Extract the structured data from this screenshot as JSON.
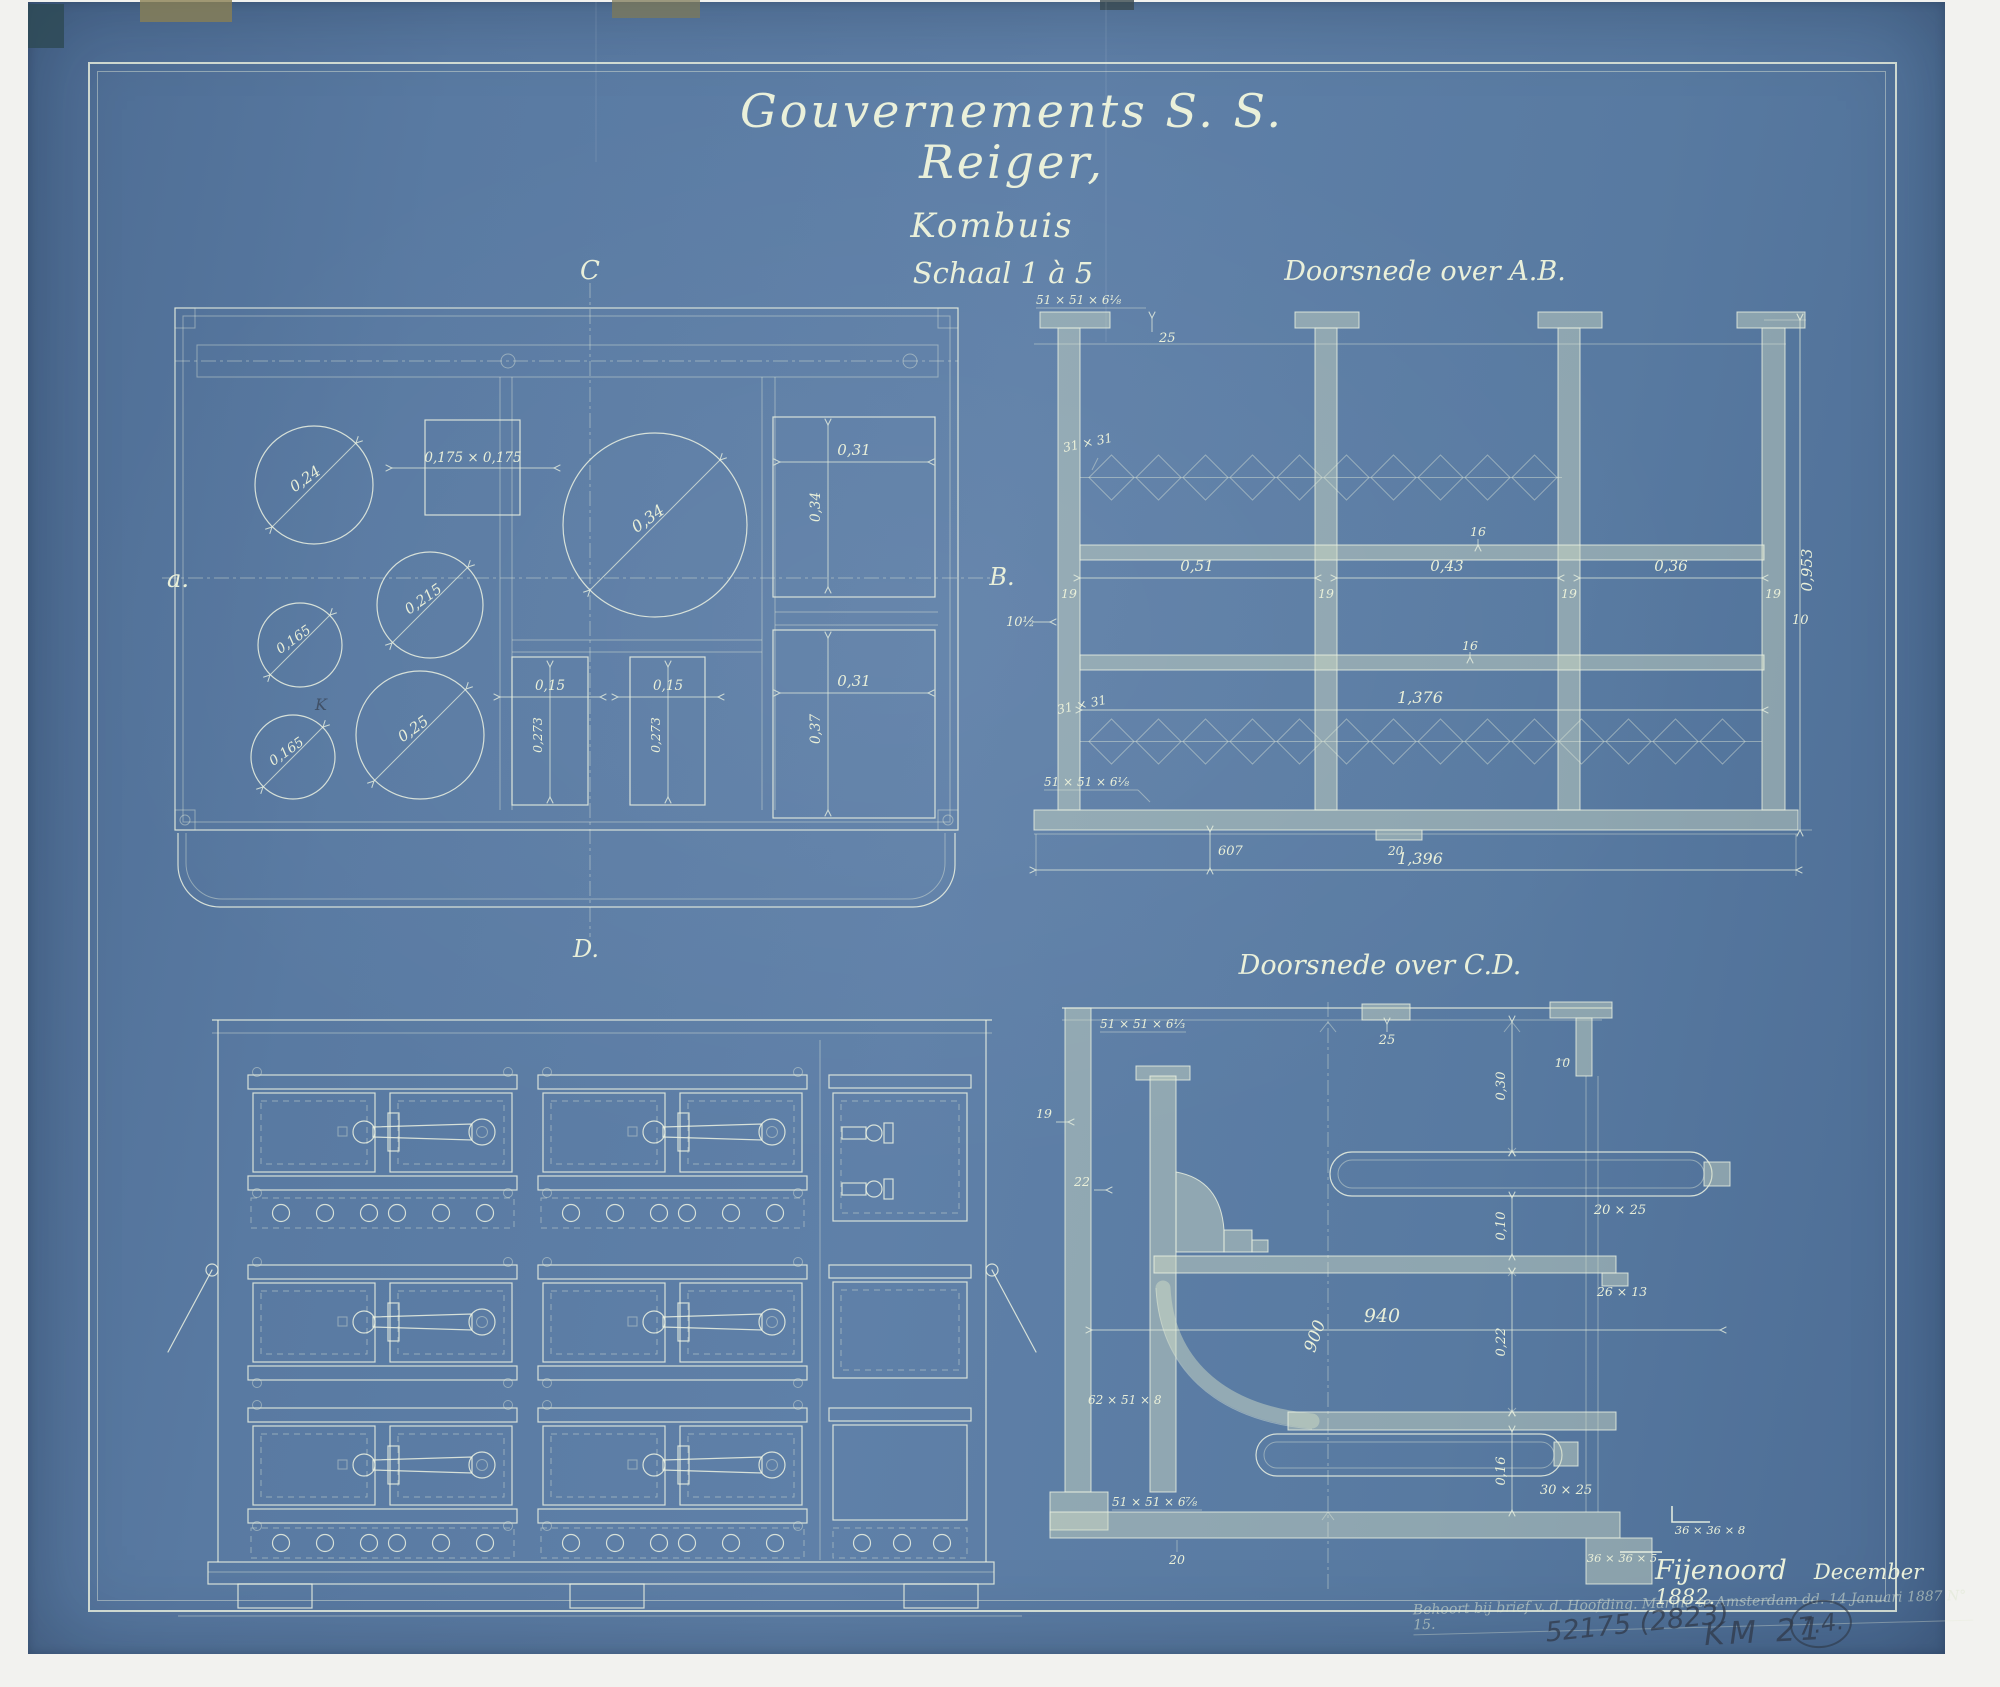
{
  "header": {
    "title": "Gouvernements S. S. Reiger,",
    "subtitle": "Kombuis",
    "scale": "Schaal 1 à 5"
  },
  "plan": {
    "marker_c": "C",
    "marker_a": "a.",
    "marker_b": "B.",
    "marker_d": "D.",
    "pencil_mark": "K",
    "dim_circle_top_left": "0,24",
    "dim_square_top": "0,175 × 0,175",
    "dim_circle_large": "0,34",
    "dim_circle_mid": "0,215",
    "dim_circle_small_upper": "0,165",
    "dim_circle_small_lower": "0,165",
    "dim_circle_bottom": "0,25",
    "dim_slot_left_w": "0,15",
    "dim_slot_left_h": "0,273",
    "dim_slot_right_w": "0,15",
    "dim_slot_right_h": "0,273",
    "dim_oven_top_w": "0,31",
    "dim_oven_top_h": "0,34",
    "dim_oven_bottom_w": "0,31",
    "dim_oven_bottom_h": "0,37"
  },
  "section_ab": {
    "title": "Doorsnede over A.B.",
    "angle_top_left": "51 × 51 × 6⅛",
    "dim_top_gap": "25",
    "grate_label_top": "31 × 31",
    "grate_label_bottom": "31 × 31",
    "angle_bottom_left": "51 × 51 × 6⅛",
    "dim_bay_left": "0,51",
    "dim_bay_mid": "0,43",
    "dim_bay_right": "0,36",
    "dim_post_1": "19",
    "dim_post_2": "19",
    "dim_post_3": "19",
    "dim_post_4": "19",
    "dim_side_left": "10½",
    "dim_side_right": "10",
    "dim_rail_upper": "16",
    "dim_rail_lower": "16",
    "dim_inner_width": "1,376",
    "dim_plinth": "607",
    "dim_foot": "20",
    "dim_overall_width": "1,396",
    "dim_overall_height": "0,953"
  },
  "section_cd": {
    "title": "Doorsnede over C.D.",
    "angle_top_left": "51 × 51 × 6⅓",
    "dim_top_gap": "25",
    "dim_top_right": "10",
    "dim_left_upper": "19",
    "dim_left_inner": "22",
    "dim_h1": "0,30",
    "dim_h2": "0,10",
    "tube_upper": "20 × 25",
    "bar_mid": "26 × 13",
    "dim_width_inner": "900",
    "dim_width_outer": "940",
    "dim_h3": "0,22",
    "dim_h4": "0,16",
    "angle_mid_left": "62 × 51 × 8",
    "angle_bottom_left": "51 × 51 × 6⅞",
    "dim_base": "20",
    "tube_lower": "30 × 25",
    "angle_right_upper": "36 × 36 × 8",
    "angle_right_lower": "36 × 36 × 5"
  },
  "footer": {
    "place": "Fijenoord",
    "date": "December 1882.",
    "ink_note": "Behoort bij brief v. d. Hoofding. Marine te Amsterdam dd. 14 Januari 1887 N° 15.",
    "pencil_ref": "52175 (2823)",
    "pencil_code": "KM 21",
    "pencil_circled": "7.4."
  }
}
